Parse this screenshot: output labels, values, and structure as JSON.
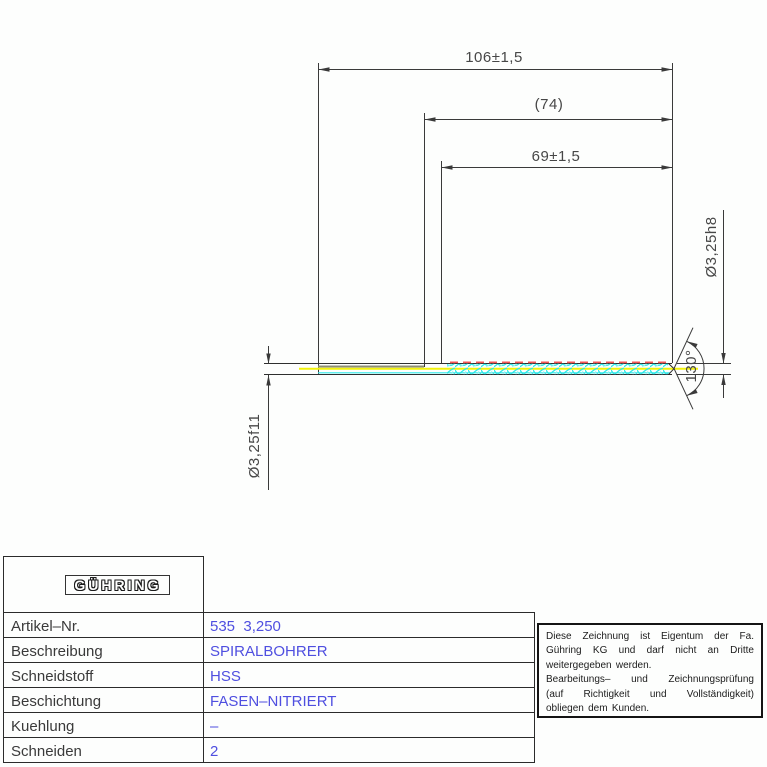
{
  "drawing": {
    "dims": {
      "total_length": "106±1,5",
      "ref_length": "(74)",
      "flute_length": "69±1,5",
      "shank_diameter": "Ø3,25f11",
      "flute_diameter": "Ø3,25h8",
      "point_angle": "130°"
    }
  },
  "table": {
    "logo": "GÜHRING",
    "rows": [
      {
        "label": "Artikel–Nr.",
        "value": "535  3,250"
      },
      {
        "label": "Beschreibung",
        "value": "SPIRALBOHRER"
      },
      {
        "label": "Schneidstoff",
        "value": "HSS"
      },
      {
        "label": "Beschichtung",
        "value": "FASEN–NITRIERT"
      },
      {
        "label": "Kuehlung",
        "value": "–"
      },
      {
        "label": "Schneiden",
        "value": "2"
      }
    ]
  },
  "notice": {
    "lines": [
      "Diese Zeichnung ist Eigentum der Fa.",
      "Gühring KG und darf nicht an Dritte",
      "weitergegeben werden.",
      "Bearbeitungs– und Zeichnungsprüfung",
      "(auf Richtigkeit und Vollständigkeit)",
      "obliegen dem Kunden."
    ]
  },
  "colors": {
    "value_blue": "#4f4fe0",
    "line_black": "#3a3a3a",
    "flute_cyan": "#2ee8e8",
    "center_yellow": "#f2f20a",
    "margin_red": "#f55555",
    "shank_olive": "#8d8d72"
  }
}
